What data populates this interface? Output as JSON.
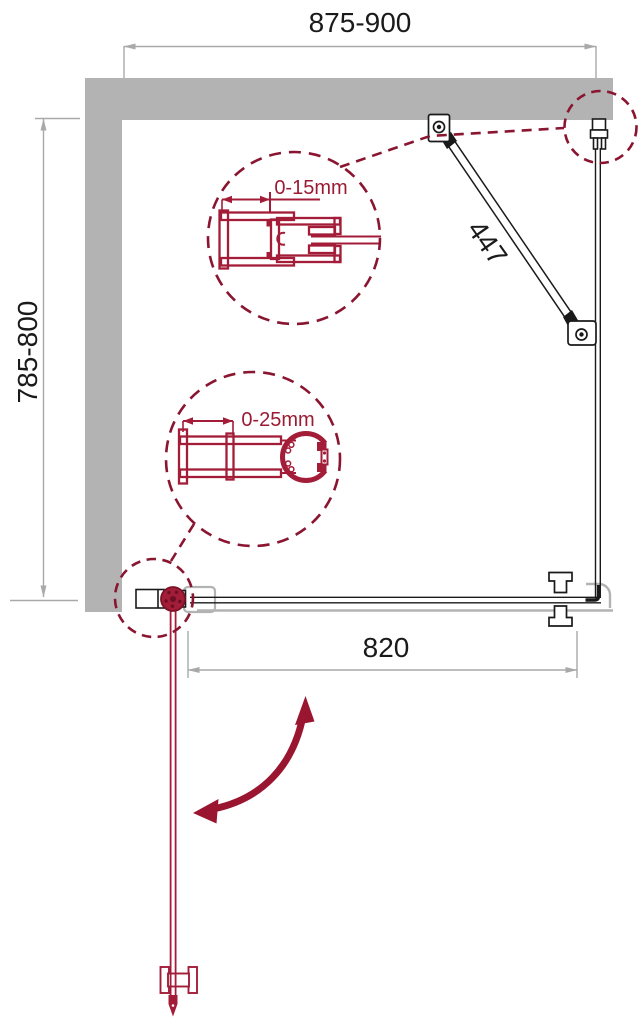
{
  "diagram": {
    "type": "technical-plan",
    "dimensions": {
      "top_width": "875-900",
      "left_depth": "785-800",
      "support_bar_length": "447",
      "front_panel_width": "820",
      "detail_top_adjustment": "0-15mm",
      "detail_bottom_adjustment": "0-25mm"
    },
    "colors": {
      "wall_gray": "#b3b3b3",
      "dimension_gray": "#a9a9a9",
      "line_black": "#1a1a1a",
      "profile_red": "#a31d39",
      "dash_maroon": "#8a1530",
      "arrow_red": "#9a1530"
    }
  }
}
